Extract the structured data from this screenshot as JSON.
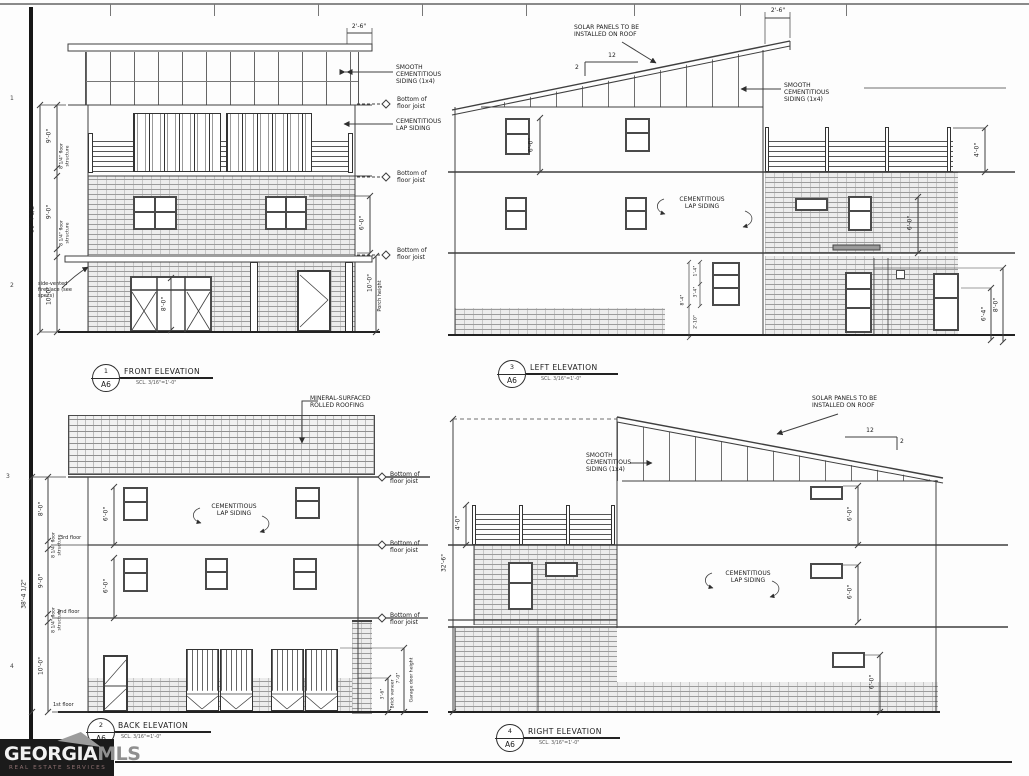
{
  "common": {
    "smooth_siding": "SMOOTH CEMENTITIOUS SIDING (1x4)",
    "lap_siding": "CEMENTITIOUS LAP SIDING",
    "bottom_joist": "Bottom of floor joist",
    "solar": "SOLAR PANELS TO BE INSTALLED ON ROOF",
    "mineral_roofing": "MINERAL-SURFACED ROLLED ROOFING",
    "floor_structure": "8 1/4\" floor structure",
    "fireplace": "side-vented fireplace (see specs)",
    "porch_height_text": "Porch height",
    "garage_height_text": "Garage door height",
    "veneer_text": "Brick veneer",
    "slope_run": "12",
    "slope_rise": "2",
    "scale": "SCL. 3/16\"=1'-0\"",
    "sheet_ref": "A6",
    "dims": {
      "d38": "38'-4 1/2\"",
      "d326": "32'-6\"",
      "d9": "9'-0\"",
      "d10": "10'-0\"",
      "d8": "8'-0\"",
      "d7": "7'-0\"",
      "d6": "6'-0\"",
      "d64": "6'-4\"",
      "d4": "4'-0\"",
      "d26": "2'-6\"",
      "d36": "3'-6\"",
      "d84": "8'-4\"",
      "d34": "3'-4\"",
      "d14": "1'-4\"",
      "d210": "2'-10\""
    },
    "floors": {
      "f3": "3rd floor",
      "f2": "2nd floor",
      "f1": "1st floor"
    }
  },
  "views": {
    "front": {
      "num": "1",
      "title": "FRONT ELEVATION"
    },
    "left": {
      "num": "3",
      "title": "LEFT ELEVATION"
    },
    "back": {
      "num": "2",
      "title": "BACK ELEVATION"
    },
    "right": {
      "num": "4",
      "title": "RIGHT ELEVATION"
    }
  },
  "sheet_marks": {
    "t1": "1",
    "t2": "2",
    "t3": "3",
    "t4": "4"
  },
  "logo": {
    "georgia": "GEORGIA",
    "mls": "MLS",
    "tagline": "REAL ESTATE SERVICES"
  }
}
